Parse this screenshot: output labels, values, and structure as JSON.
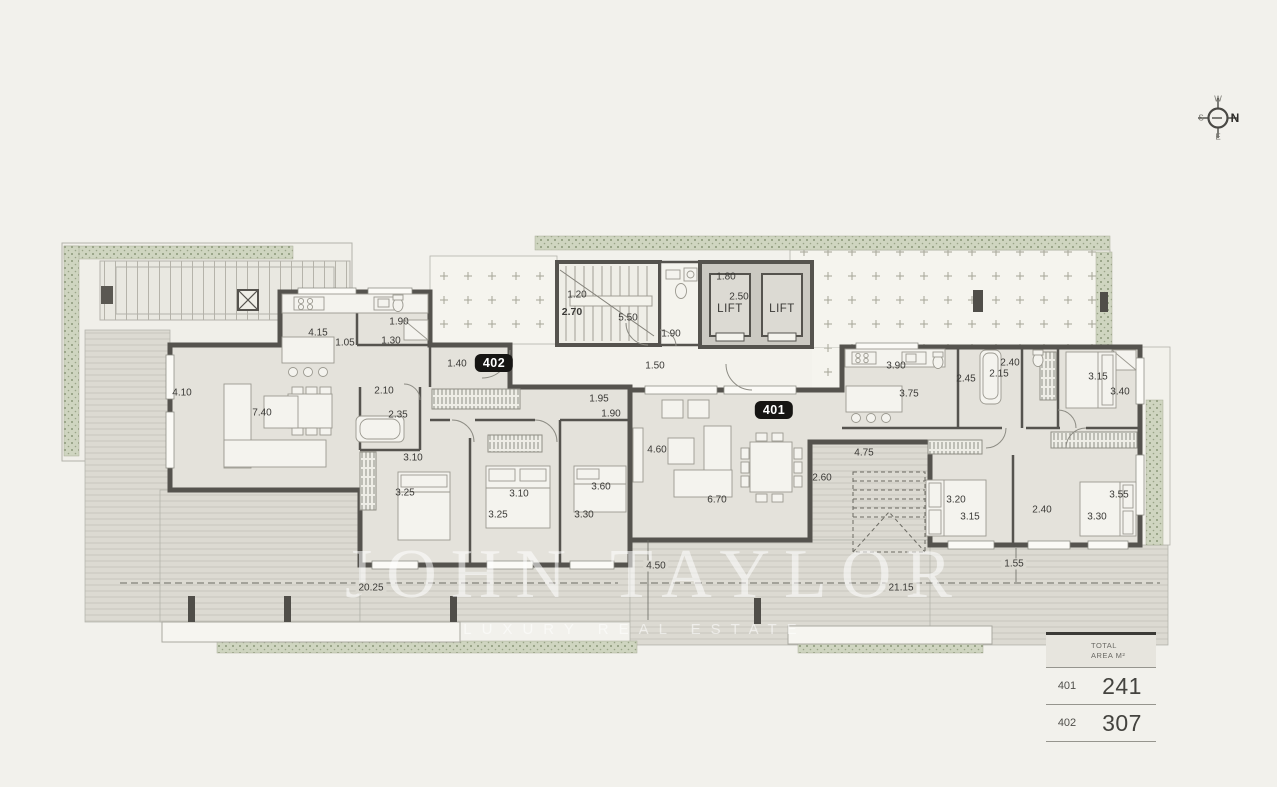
{
  "header": {
    "title": "FLOOR 4",
    "section": "FLOOR PLANS"
  },
  "compass": {
    "north": "N",
    "south": "S",
    "east": "E",
    "west": "W"
  },
  "watermark": {
    "title": "JOHN TAYLOR",
    "subtitle": "LUXURY REAL ESTATE"
  },
  "area_table": {
    "header_line1": "TOTAL",
    "header_line2": "AREA M²",
    "rows": [
      {
        "unit": "401",
        "area": "241"
      },
      {
        "unit": "402",
        "area": "307"
      }
    ]
  },
  "plan": {
    "units": [
      {
        "label": "402",
        "x": 494,
        "y": 363
      },
      {
        "label": "401",
        "x": 774,
        "y": 410
      }
    ],
    "lifts": [
      {
        "label": "LIFT",
        "x": 730,
        "y": 309
      },
      {
        "label": "LIFT",
        "x": 782,
        "y": 309
      }
    ],
    "dimensions": [
      {
        "t": "1.20",
        "x": 577,
        "y": 295
      },
      {
        "t": "2.70",
        "x": 572,
        "y": 312,
        "b": 1
      },
      {
        "t": "5.50",
        "x": 628,
        "y": 318
      },
      {
        "t": "1.90",
        "x": 671,
        "y": 334
      },
      {
        "t": "1.80",
        "x": 726,
        "y": 277
      },
      {
        "t": "2.50",
        "x": 739,
        "y": 297
      },
      {
        "t": "1.50",
        "x": 655,
        "y": 366
      },
      {
        "t": "1.40",
        "x": 457,
        "y": 364
      },
      {
        "t": "4.15",
        "x": 318,
        "y": 333
      },
      {
        "t": "1.05",
        "x": 345,
        "y": 343
      },
      {
        "t": "1.90",
        "x": 399,
        "y": 322
      },
      {
        "t": "1.30",
        "x": 391,
        "y": 341
      },
      {
        "t": "4.10",
        "x": 182,
        "y": 393
      },
      {
        "t": "7.40",
        "x": 262,
        "y": 413
      },
      {
        "t": "2.10",
        "x": 384,
        "y": 391
      },
      {
        "t": "2.35",
        "x": 398,
        "y": 415
      },
      {
        "t": "3.10",
        "x": 413,
        "y": 458
      },
      {
        "t": "3.25",
        "x": 405,
        "y": 493
      },
      {
        "t": "3.10",
        "x": 519,
        "y": 494
      },
      {
        "t": "3.25",
        "x": 498,
        "y": 515
      },
      {
        "t": "3.60",
        "x": 601,
        "y": 487
      },
      {
        "t": "3.30",
        "x": 584,
        "y": 515
      },
      {
        "t": "1.95",
        "x": 599,
        "y": 399
      },
      {
        "t": "1.90",
        "x": 611,
        "y": 414
      },
      {
        "t": "4.60",
        "x": 657,
        "y": 450
      },
      {
        "t": "6.70",
        "x": 717,
        "y": 500
      },
      {
        "t": "2.60",
        "x": 822,
        "y": 478
      },
      {
        "t": "4.75",
        "x": 864,
        "y": 453
      },
      {
        "t": "3.90",
        "x": 896,
        "y": 366
      },
      {
        "t": "3.75",
        "x": 909,
        "y": 394
      },
      {
        "t": "2.45",
        "x": 966,
        "y": 379
      },
      {
        "t": "2.40",
        "x": 1010,
        "y": 363
      },
      {
        "t": "2.15",
        "x": 999,
        "y": 374
      },
      {
        "t": "3.15",
        "x": 1098,
        "y": 377
      },
      {
        "t": "3.40",
        "x": 1120,
        "y": 392
      },
      {
        "t": "3.20",
        "x": 956,
        "y": 500
      },
      {
        "t": "3.15",
        "x": 970,
        "y": 517
      },
      {
        "t": "2.40",
        "x": 1042,
        "y": 510
      },
      {
        "t": "3.55",
        "x": 1119,
        "y": 495
      },
      {
        "t": "3.30",
        "x": 1097,
        "y": 517
      },
      {
        "t": "1.55",
        "x": 1014,
        "y": 564,
        "bg": 1
      },
      {
        "t": "4.50",
        "x": 656,
        "y": 566,
        "bg": 1
      },
      {
        "t": "20.25",
        "x": 371,
        "y": 588,
        "bg": 1
      },
      {
        "t": "21.15",
        "x": 901,
        "y": 588,
        "bg": 1
      }
    ]
  }
}
